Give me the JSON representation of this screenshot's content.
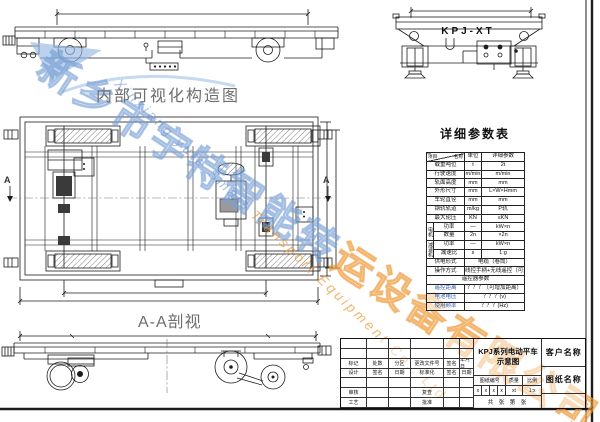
{
  "labels": {
    "internal_view": "内部可视化构造图",
    "section_view": "A-A剖视",
    "end_view_model": "KPJ-XT",
    "param_table_title": "详细参数表",
    "section_marker": "A"
  },
  "param_table": {
    "header": {
      "name": "名称",
      "item": "项目",
      "unit": "单位",
      "value": "详细参数"
    },
    "rows": [
      {
        "label": "载重吨位",
        "unit": "t",
        "value": "2t"
      },
      {
        "label": "行驶速度",
        "unit": "m/min",
        "value": "m/min"
      },
      {
        "label": "轨面高度",
        "unit": "mm",
        "value": "mm"
      },
      {
        "label": "外形尺寸",
        "unit": "mm",
        "value": "L×W×Hmm"
      },
      {
        "label": "车轮直径",
        "unit": "mm",
        "value": "mm"
      },
      {
        "label": "钢轨轨道",
        "unit": "m/kg",
        "value": "P轨"
      },
      {
        "label": "最大轮压",
        "unit": "KN",
        "value": "≤KN"
      }
    ],
    "motor_group": {
      "label": "电机",
      "rows": [
        {
          "label": "功率",
          "unit": "—",
          "value": "kW×n"
        },
        {
          "label": "数量",
          "unit": "2n",
          "value": "×2n"
        }
      ]
    },
    "reducer_group": {
      "label": "减速机",
      "rows": [
        {
          "label": "功率",
          "unit": "—",
          "value": "kW×n"
        },
        {
          "label": "减速比",
          "unit": "s",
          "value": "1:g"
        }
      ]
    },
    "supply_row": {
      "label": "供电形式",
      "value": "电缆（卷筒）"
    },
    "operate_row": {
      "label": "操作方式",
      "value": "线控手柄+无线遥控（可选）"
    },
    "remote_header": "遥控器参数",
    "remote_rows": [
      {
        "label": "遥控距离",
        "value": "？？？（可增加距离）"
      },
      {
        "label": "电池电压",
        "value": "？？？(v)"
      },
      {
        "label": "使用频率",
        "value": "？？？(Hz)"
      }
    ]
  },
  "title_block": {
    "drawing_name_1": "KPJ系列电动平车",
    "drawing_name_2": "示意图",
    "customer_label": "客户名称",
    "sheet_name_label": "图纸名称",
    "rev_cols": [
      "标记",
      "处数",
      "分区",
      "更改文件号",
      "签名",
      "年月日"
    ],
    "sign_cols": [
      "设计",
      "签名",
      "日期",
      "标准化",
      "签名",
      "日期"
    ],
    "audit_label": "审核",
    "recheck_label": "复查",
    "craft_label": "工艺",
    "approve_label": "批准",
    "drawing_no_label": "图纸编号",
    "weight_label": "质量",
    "scale_label": "比例",
    "drawing_no_cells": [
      "x",
      "x",
      "x",
      "x"
    ],
    "weight_value": "xt",
    "scale_value": "1:x",
    "sheet_count": "共 张  第 张"
  },
  "watermark": {
    "company_cn_blue": "新乡市宇特智能转",
    "company_cn_orange": "运设备有限公司",
    "company_en_blue": "Xinxiang yute Smart ",
    "company_en_orange": "Transport Equipment Co., Ltd",
    "blue": "#7fa8d9",
    "orange": "#f09a3c"
  },
  "colors": {
    "line": "#1c1c1c",
    "label_gray": "#6e6e6e",
    "table_blue": "#2f5fae"
  }
}
